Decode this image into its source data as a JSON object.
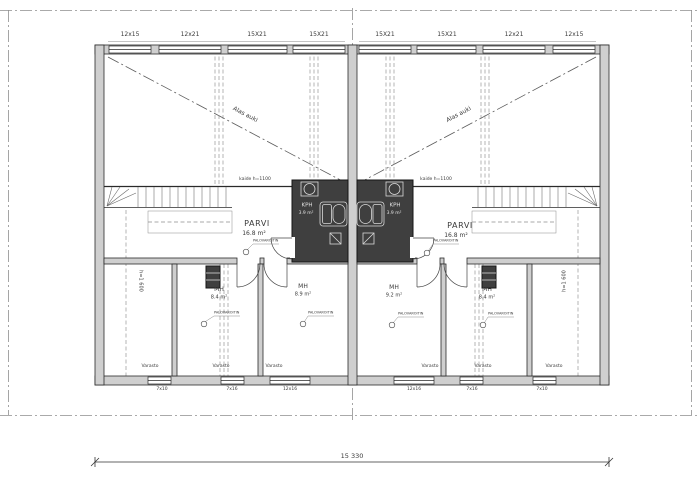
{
  "plan_labels": {
    "top_windows": [
      "12x15",
      "12x21",
      "15X21",
      "15X21",
      "15X21",
      "15X21",
      "12x21",
      "12x15"
    ],
    "bottom_windows": [
      "7x10",
      "7x16",
      "12x16",
      "12x16",
      "7x16",
      "7x10"
    ],
    "void_left": "Alas auki",
    "void_right": "Alas auki",
    "railing_left": "kaide h=1100",
    "railing_right": "kaide h=1100",
    "height_left": "h=1 600",
    "height_right": "h=1 600",
    "smoke_detector": "PALOVAROITIN",
    "storage": "Varasto",
    "total_width_dim": "15 330"
  },
  "rooms": {
    "parvi_left": {
      "name": "PARVI",
      "area": "16.8 m²"
    },
    "parvi_right": {
      "name": "PARVI",
      "area": "16.8 m²"
    },
    "kph_left": {
      "name": "KPH",
      "area": "3.9 m²"
    },
    "kph_right": {
      "name": "KPH",
      "area": "3.9 m²"
    },
    "mh1": {
      "name": "MH",
      "area": "8.4 m²"
    },
    "mh2": {
      "name": "MH",
      "area": "8.9 m²"
    },
    "mh3": {
      "name": "MH",
      "area": "9.2 m²"
    },
    "mh4": {
      "name": "MH",
      "area": "8.4 m²"
    }
  },
  "colors": {
    "wall_fill": "#cfcfcf",
    "dark_room": "#3f3f3f",
    "line": "#2a2a2a",
    "reference": "#8f8f8f",
    "text": "#3a3a3a"
  }
}
